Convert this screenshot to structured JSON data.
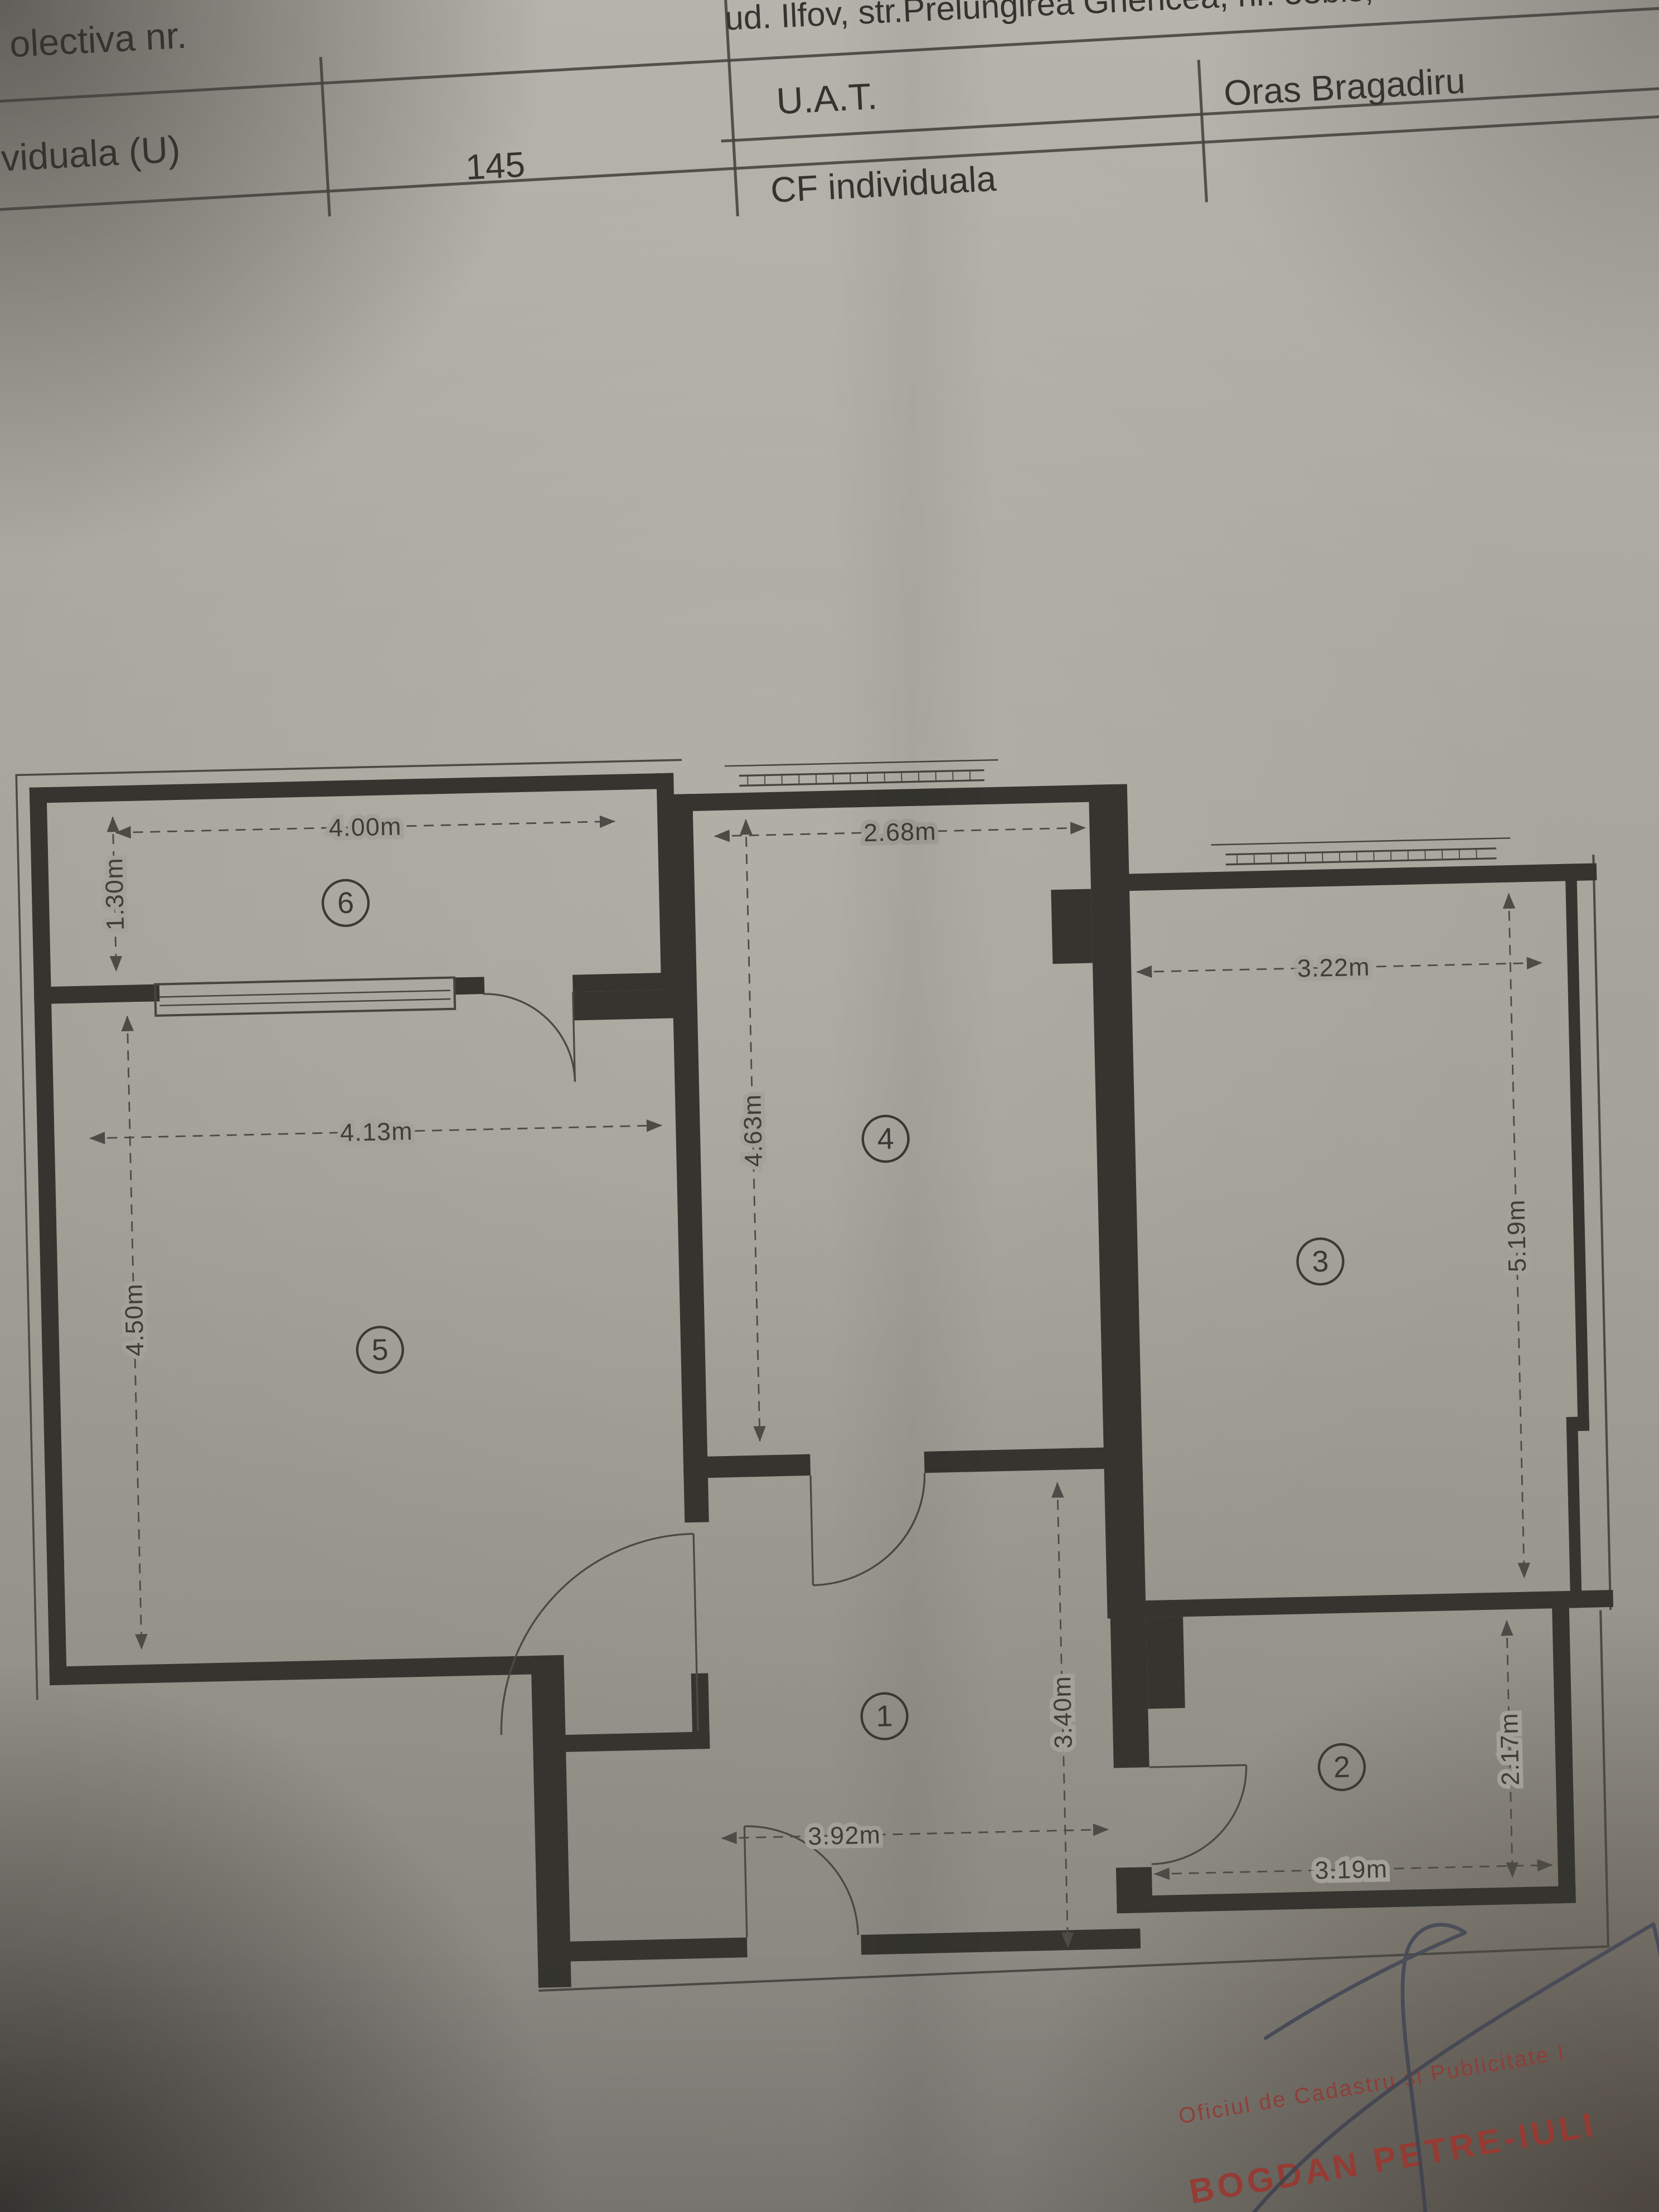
{
  "header": {
    "address_line": "ud. Ilfov, str.Prelungirea Ghencea, nr. 53bis, bloc F3",
    "table": {
      "collective_label": "olectiva nr.",
      "individual_label": "viduala (U)",
      "individual_number": "145",
      "uat_label": "U.A.T.",
      "uat_value": "Oras Bragadiru",
      "cf_individual_label": "CF individuala"
    }
  },
  "plan": {
    "rooms": [
      {
        "number": "1"
      },
      {
        "number": "2"
      },
      {
        "number": "3"
      },
      {
        "number": "4"
      },
      {
        "number": "5"
      },
      {
        "number": "6"
      }
    ],
    "dimensions": {
      "balcony_width": "4.00m",
      "balcony_depth": "1.30m",
      "room4_width": "2.68m",
      "room4_depth": "4.63m",
      "room3_width": "3.22m",
      "room3_depth": "5.19m",
      "room5_width": "4.13m",
      "room5_depth": "4.50m",
      "hall_width": "3.92m",
      "hall_depth": "3.40m",
      "room2_width": "3.19m",
      "room2_depth": "2.17m"
    }
  },
  "stamp": {
    "office_line": "Oficiul de Cadastru şi Publicitate I",
    "name_line": "BOGDAN PETRE-IULI"
  },
  "colors": {
    "paper": "#a3a198",
    "ink": "#35342f",
    "dim_line": "#4c4b45",
    "stamp_red": "#a03a33",
    "signature_ink": "#474a58"
  }
}
